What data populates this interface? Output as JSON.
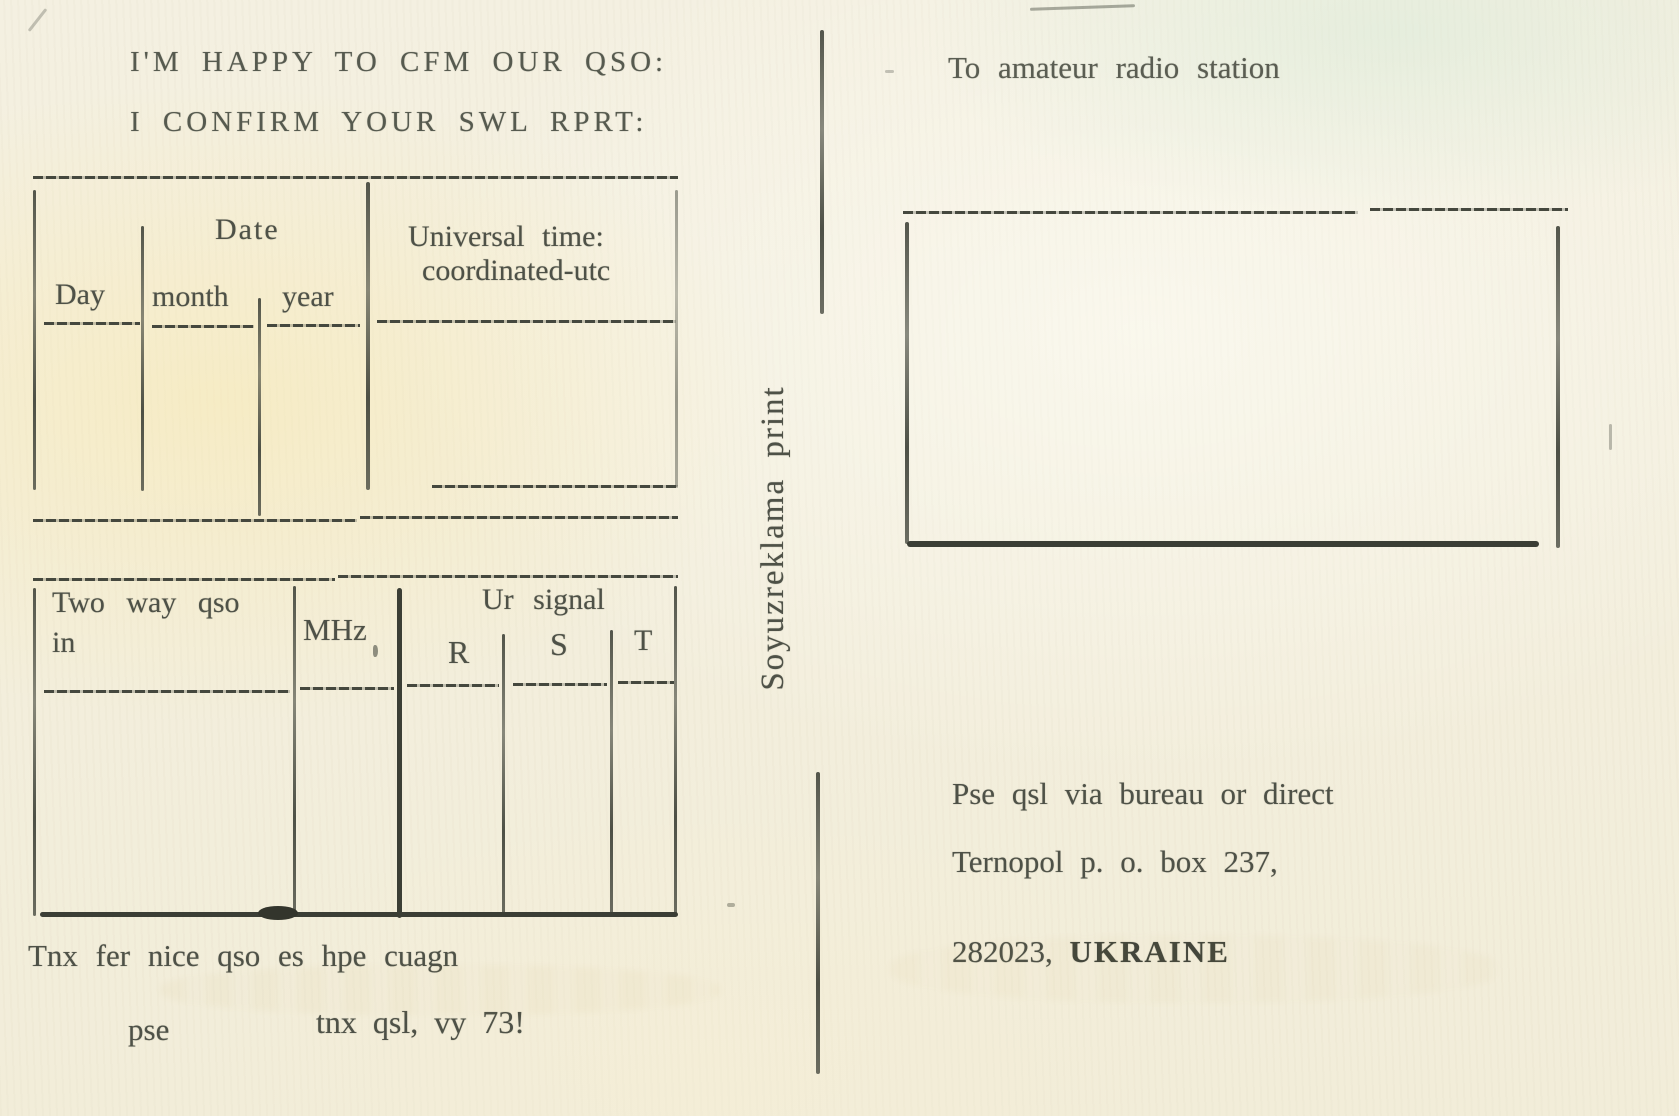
{
  "postcard": {
    "titles": {
      "line1": "I'M HAPPY TO CFM OUR QSO:",
      "line2": "I CONFIRM YOUR SWL RPRT:"
    },
    "date_table": {
      "group_header": "Date",
      "col_day": "Day",
      "col_month": "month",
      "col_year": "year",
      "utc_line1": "Universal time:",
      "utc_line2": "coordinated-utc"
    },
    "qso_table": {
      "col_mode_line1": "Two way qso",
      "col_mode_line2": "in",
      "col_mhz": "MHz",
      "signal_group_header": "Ur signal",
      "col_r": "R",
      "col_s": "S",
      "col_t": "T"
    },
    "closing": {
      "line1": "Tnx fer nice qso es hpe cuagn",
      "pse": "pse",
      "line2": "tnx qsl, vy 73!"
    },
    "printer_credit": "Soyuzreklama print",
    "address_side": {
      "to_label": "To amateur radio station",
      "line1": "Pse qsl via bureau or direct",
      "line2": "Ternopol p. o. box 237,",
      "line3_zip": "282023,",
      "line3_country": "UKRAINE"
    },
    "colors": {
      "paper": "#f3eedd",
      "ink": "#4e5147",
      "line": "#45483e"
    }
  }
}
